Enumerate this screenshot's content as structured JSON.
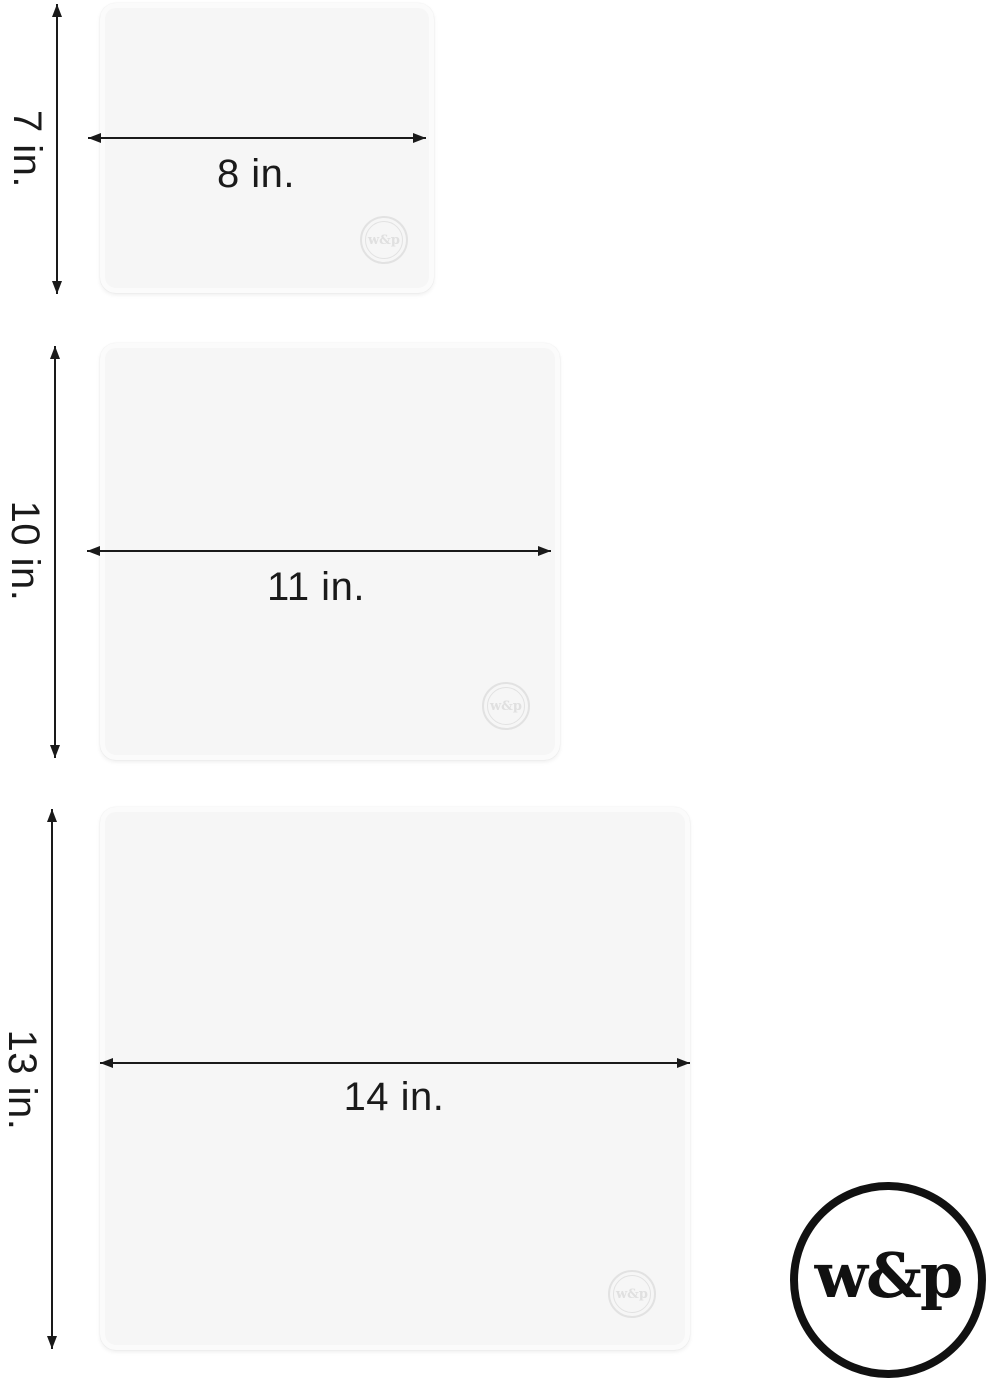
{
  "image": {
    "kind": "product dimensions diagram",
    "background": "#ffffff"
  },
  "colors": {
    "dimension_line": "#1a1a1a",
    "label_text": "#1a1a1a",
    "mat_fill": "#f6f6f6",
    "mat_edge": "#fbfbfb",
    "watermark": "#e2e2e2",
    "brand": "#111111"
  },
  "mats": [
    {
      "size": "small",
      "height_label": "7 in.",
      "width_label": "8 in.",
      "watermark_text": "w&p"
    },
    {
      "size": "medium",
      "height_label": "10 in.",
      "width_label": "11 in.",
      "watermark_text": "w&p"
    },
    {
      "size": "large",
      "height_label": "13 in.",
      "width_label": "14 in.",
      "watermark_text": "w&p"
    }
  ],
  "brand_logo": {
    "text": "w&p"
  }
}
